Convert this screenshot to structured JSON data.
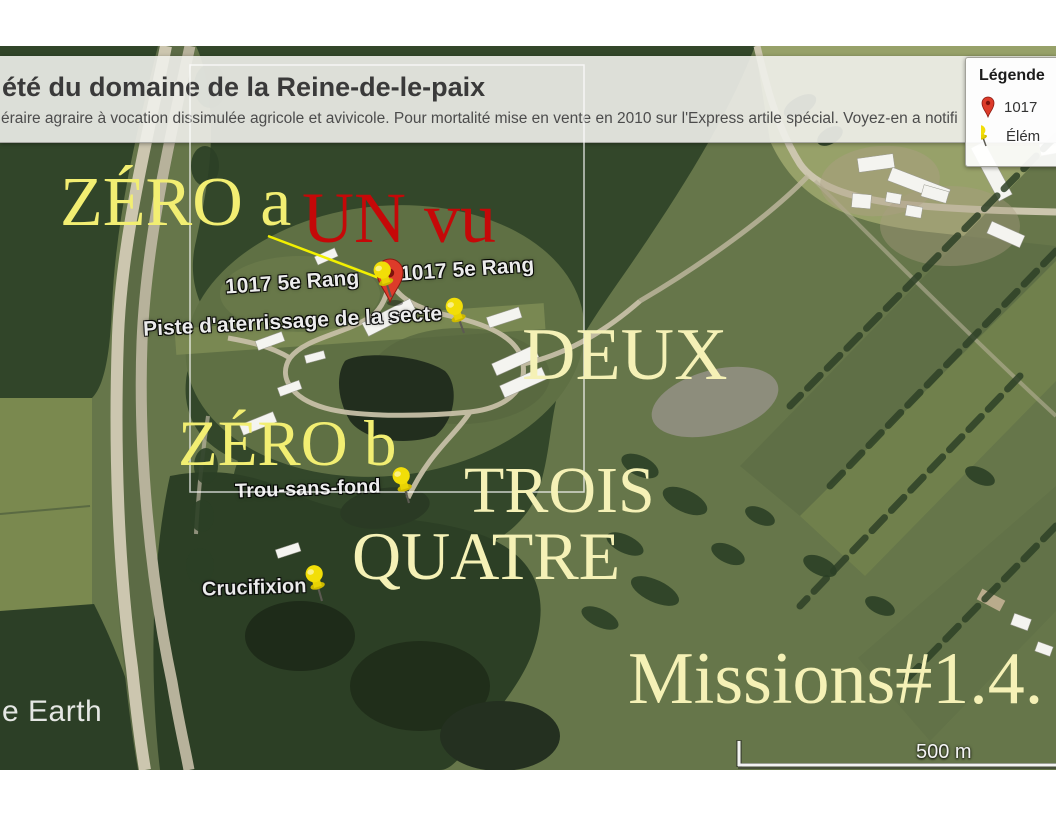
{
  "header": {
    "title": "été du domaine de la Reine-de-le-paix",
    "subtitle": "éraire agraire à vocation dissimulée agricole et avivicole. Pour mortalité mise en vente en 2010 sur l'Express artile spécial. Voyez-en a notifi"
  },
  "legend": {
    "title": "Légende",
    "items": [
      {
        "icon": "red-map-pin-icon",
        "label": "1017"
      },
      {
        "icon": "yellow-pushpin-icon",
        "label": "Élém"
      }
    ]
  },
  "annotations": {
    "zero_a": "ZÉRO a",
    "un_vu": "UN vu",
    "deux": "DEUX",
    "zero_b": "ZÉRO b",
    "trois": "TROIS",
    "quatre": "QUATRE",
    "missions": "Missions#1.4."
  },
  "map_labels": {
    "rang_left": "1017 5e Rang",
    "rang_right": "1017 5e Rang",
    "piste": "Piste d'aterrissage de la secte",
    "trou": "Trou-sans-fond",
    "crucifixion": "Crucifixion"
  },
  "scale_bar": {
    "label": "500 m"
  },
  "watermark": "e Earth",
  "colors": {
    "annotation_yellow_bright": "#f2ee72",
    "annotation_yellow_cream": "#f5f1b6",
    "annotation_red": "#c50808",
    "pushpin_yellow": "#f2de08",
    "map_pin_red": "#dd3b2a"
  }
}
